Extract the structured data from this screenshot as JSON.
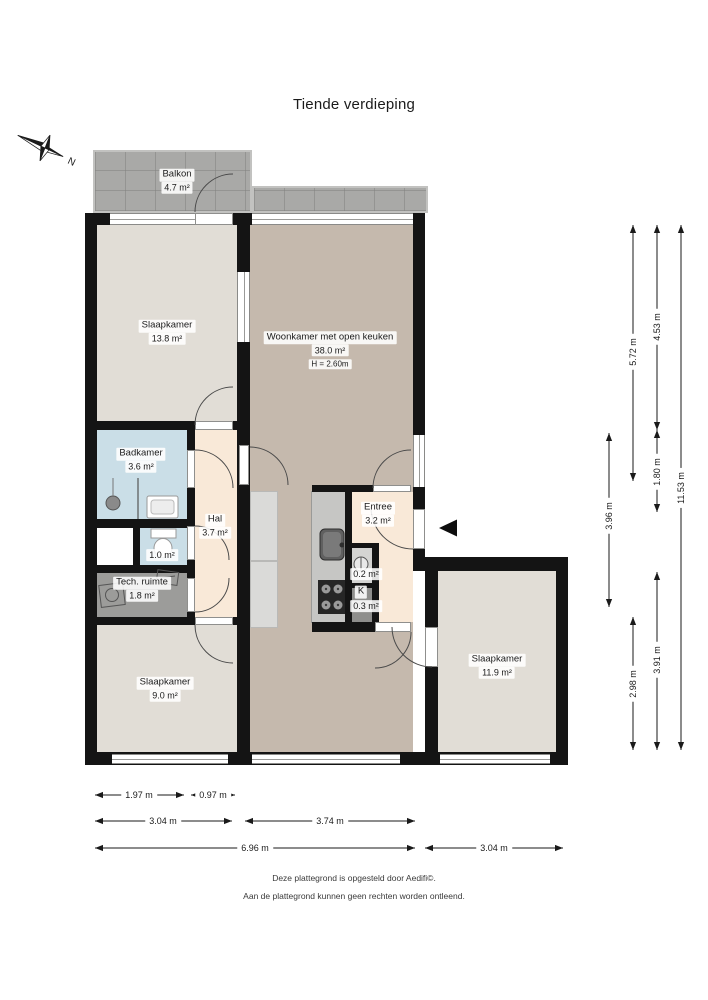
{
  "title": "Tiende verdieping",
  "compass": {
    "north_label": "N"
  },
  "rooms": {
    "balkon": {
      "name": "Balkon",
      "area": "4.7 m²"
    },
    "slaapkamer_1": {
      "name": "Slaapkamer",
      "area": "13.8 m²"
    },
    "woonkamer": {
      "name": "Woonkamer met open keuken",
      "area": "38.0 m²",
      "ceiling_height": "H = 2.60m"
    },
    "badkamer": {
      "name": "Badkamer",
      "area": "3.6 m²"
    },
    "toilet": {
      "area": "1.0 m²"
    },
    "hal": {
      "name": "Hal",
      "area": "3.7 m²"
    },
    "tech_ruimte": {
      "name": "Tech. ruimte",
      "area": "1.8 m²"
    },
    "entree": {
      "name": "Entree",
      "area": "3.2 m²"
    },
    "meterkast": {
      "area": "0.2 m²"
    },
    "kast": {
      "name": "K",
      "area": "0.3 m²"
    },
    "slaapkamer_2": {
      "name": "Slaapkamer",
      "area": "9.0 m²"
    },
    "slaapkamer_3": {
      "name": "Slaapkamer",
      "area": "11.9 m²"
    }
  },
  "dimensions": {
    "right": [
      "3.96 m",
      "5.72 m",
      "2.98 m",
      "4.53 m",
      "1.80 m",
      "3.91 m",
      "11.53 m"
    ],
    "bottom": [
      "1.97 m",
      "0.97 m",
      "3.04 m",
      "3.74 m",
      "6.96 m",
      "3.04 m"
    ]
  },
  "footer": {
    "line1": "Deze plattegrond is opgesteld door Aedifi©.",
    "line2": "Aan de plattegrond kunnen geen rechten worden ontleend."
  },
  "colors": {
    "wall": "#141414",
    "floor_living": "#c5b9ad",
    "floor_bedroom": "#e1ddd6",
    "floor_bath": "#cadee7",
    "floor_hall": "#f9e9d8",
    "floor_tech": "#9c9c9a",
    "balcony_tile": "#a9a9a7"
  }
}
